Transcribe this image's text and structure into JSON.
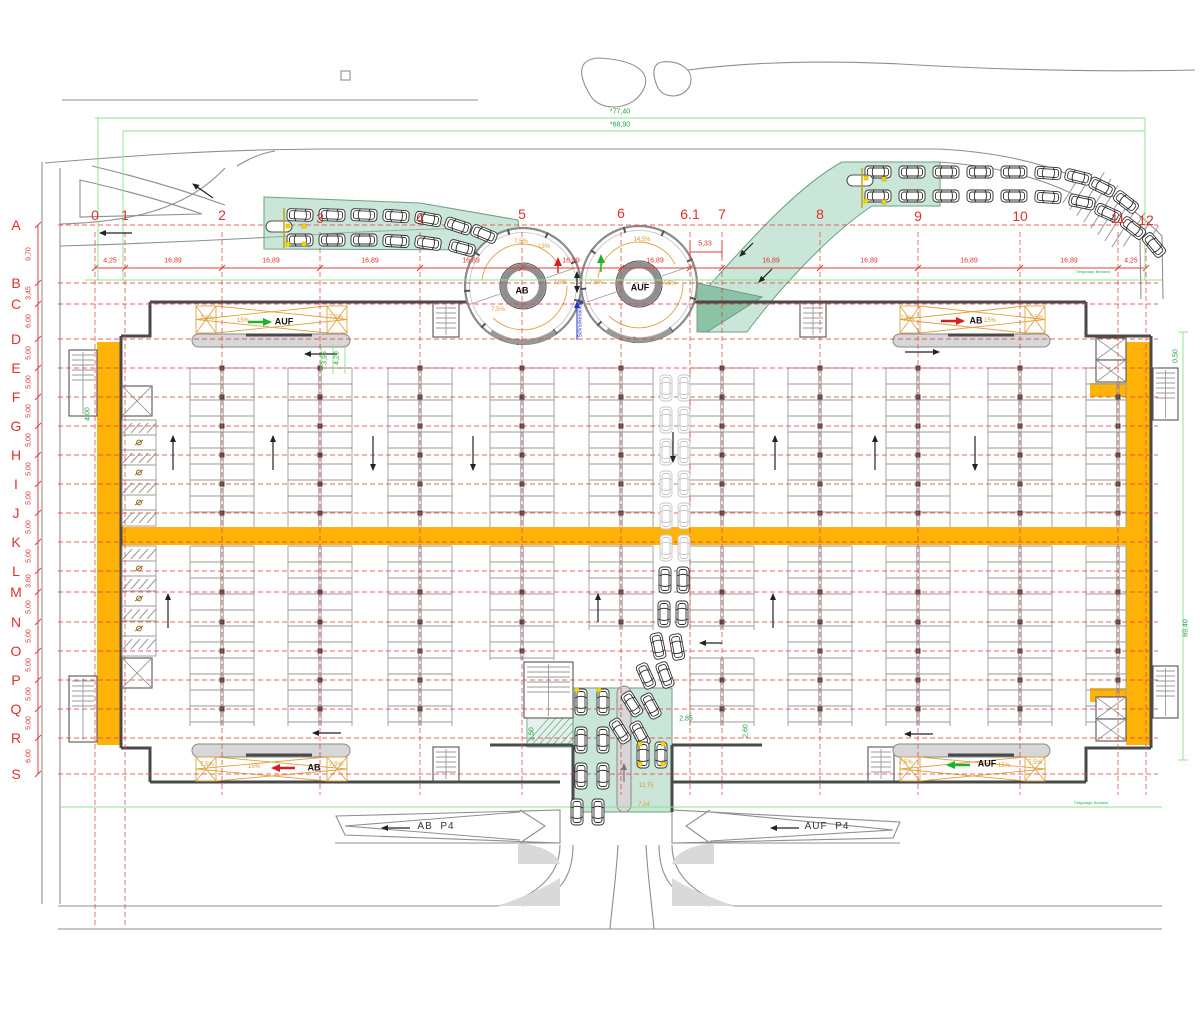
{
  "drawing_type": "parking-garage-floor-plan",
  "grid": {
    "columns": [
      {
        "label": "0",
        "x": 95,
        "y": 215
      },
      {
        "label": "1",
        "x": 125,
        "y": 215
      },
      {
        "label": "2",
        "x": 222,
        "y": 215
      },
      {
        "label": "3",
        "x": 320,
        "y": 218
      },
      {
        "label": "4",
        "x": 420,
        "y": 218
      },
      {
        "label": "5",
        "x": 522,
        "y": 214
      },
      {
        "label": "6",
        "x": 621,
        "y": 213
      },
      {
        "label": "6.1",
        "x": 690,
        "y": 214
      },
      {
        "label": "7",
        "x": 722,
        "y": 214
      },
      {
        "label": "8",
        "x": 820,
        "y": 214
      },
      {
        "label": "9",
        "x": 918,
        "y": 216
      },
      {
        "label": "10",
        "x": 1020,
        "y": 216
      },
      {
        "label": "11",
        "x": 1118,
        "y": 218
      },
      {
        "label": "12",
        "x": 1146,
        "y": 220
      }
    ],
    "rows": [
      {
        "label": "A",
        "y": 225
      },
      {
        "label": "B",
        "y": 283
      },
      {
        "label": "C",
        "y": 304
      },
      {
        "label": "D",
        "y": 339
      },
      {
        "label": "E",
        "y": 368
      },
      {
        "label": "F",
        "y": 397
      },
      {
        "label": "G",
        "y": 426
      },
      {
        "label": "H",
        "y": 455
      },
      {
        "label": "I",
        "y": 484
      },
      {
        "label": "J",
        "y": 513
      },
      {
        "label": "K",
        "y": 542
      },
      {
        "label": "L",
        "y": 571
      },
      {
        "label": "M",
        "y": 592
      },
      {
        "label": "N",
        "y": 622
      },
      {
        "label": "O",
        "y": 651
      },
      {
        "label": "P",
        "y": 680
      },
      {
        "label": "Q",
        "y": 709
      },
      {
        "label": "R",
        "y": 738
      },
      {
        "label": "S",
        "y": 774
      }
    ]
  },
  "dimensions": {
    "top_chain": [
      {
        "t": "4,25",
        "x": 110
      },
      {
        "t": "16,89",
        "x": 173
      },
      {
        "t": "16,89",
        "x": 271
      },
      {
        "t": "16,89",
        "x": 370
      },
      {
        "t": "16,89",
        "x": 471
      },
      {
        "t": "16,89",
        "x": 571
      },
      {
        "t": "16,89",
        "x": 655
      },
      {
        "t": "16,89",
        "x": 771
      },
      {
        "t": "16,89",
        "x": 869
      },
      {
        "t": "16,89",
        "x": 969
      },
      {
        "t": "16,89",
        "x": 1069
      },
      {
        "t": "4,25",
        "x": 1131
      }
    ],
    "left_chain": [
      {
        "t": "9,70",
        "y": 254
      },
      {
        "t": "3,45",
        "y": 293
      },
      {
        "t": "6,00",
        "y": 321
      },
      {
        "t": "5,00",
        "y": 353
      },
      {
        "t": "5,00",
        "y": 382
      },
      {
        "t": "5,00",
        "y": 411
      },
      {
        "t": "5,00",
        "y": 440
      },
      {
        "t": "5,00",
        "y": 469
      },
      {
        "t": "5,00",
        "y": 498
      },
      {
        "t": "5,00",
        "y": 527
      },
      {
        "t": "5,00",
        "y": 556
      },
      {
        "t": "3,60",
        "y": 581
      },
      {
        "t": "5,00",
        "y": 607
      },
      {
        "t": "5,00",
        "y": 636
      },
      {
        "t": "5,00",
        "y": 665
      },
      {
        "t": "5,00",
        "y": 694
      },
      {
        "t": "5,00",
        "y": 723
      },
      {
        "t": "6,00",
        "y": 756
      }
    ],
    "overall": [
      {
        "t": "*77,40",
        "x": 620,
        "y": 112
      },
      {
        "t": "*68,90",
        "x": 620,
        "y": 125
      },
      {
        "t": "69,40",
        "x": 1186,
        "y": 628,
        "rot": 1
      }
    ],
    "local": [
      {
        "t": "5,33",
        "x": 705,
        "y": 244,
        "cls": "t-dim"
      },
      {
        "t": "3,95",
        "x": 325,
        "y": 358,
        "rot": 1
      },
      {
        "t": "4,20",
        "x": 337,
        "y": 358,
        "rot": 1
      },
      {
        "t": "4,00",
        "x": 88,
        "y": 414,
        "rot": 1
      },
      {
        "t": "0,50",
        "x": 1176,
        "y": 356,
        "rot": 1
      },
      {
        "t": "2,85",
        "x": 686,
        "y": 719
      },
      {
        "t": "2,60",
        "x": 746,
        "y": 731,
        "rot": 1
      },
      {
        "t": "2,50",
        "x": 532,
        "y": 734,
        "rot": 1
      },
      {
        "t": "12,75",
        "x": 646,
        "y": 786,
        "cls": "t-org"
      },
      {
        "t": "7,04",
        "x": 644,
        "y": 805,
        "cls": "t-org"
      }
    ]
  },
  "ramps": {
    "inner_labels": [
      {
        "t": "AUF",
        "x": 284,
        "y": 322
      },
      {
        "t": "AB",
        "x": 976,
        "y": 321
      },
      {
        "t": "AB",
        "x": 314,
        "y": 768
      },
      {
        "t": "AUF",
        "x": 987,
        "y": 764
      }
    ],
    "spiral_labels": [
      {
        "t": "AB",
        "x": 522,
        "y": 291
      },
      {
        "t": "AUF",
        "x": 640,
        "y": 288
      }
    ],
    "grade_labels": [
      {
        "t": "7,5%",
        "x": 207,
        "y": 319
      },
      {
        "t": "15%",
        "x": 243,
        "y": 321
      },
      {
        "t": "7,5%",
        "x": 336,
        "y": 318
      },
      {
        "t": "7,5%",
        "x": 907,
        "y": 319
      },
      {
        "t": "15%",
        "x": 990,
        "y": 321
      },
      {
        "t": "7,5%",
        "x": 1036,
        "y": 318
      },
      {
        "t": "7,5%",
        "x": 207,
        "y": 765
      },
      {
        "t": "15%",
        "x": 254,
        "y": 767
      },
      {
        "t": "7,5%",
        "x": 336,
        "y": 765
      },
      {
        "t": "7,5%",
        "x": 906,
        "y": 763
      },
      {
        "t": "15%",
        "x": 1004,
        "y": 766
      },
      {
        "t": "7,5%",
        "x": 1035,
        "y": 763
      },
      {
        "t": "7,5%",
        "x": 521,
        "y": 242
      },
      {
        "t": "13%",
        "x": 544,
        "y": 247
      },
      {
        "t": "14,5%",
        "x": 642,
        "y": 240
      },
      {
        "t": "7,5%",
        "x": 498,
        "y": 310
      },
      {
        "t": "7,5%",
        "x": 560,
        "y": 283
      },
      {
        "t": "7,5%",
        "x": 596,
        "y": 283
      },
      {
        "t": "14,5%",
        "x": 668,
        "y": 284
      }
    ]
  },
  "roads": {
    "labels": [
      {
        "t": "AB  P4",
        "x": 436,
        "y": 827
      },
      {
        "t": "AUF  P4",
        "x": 827,
        "y": 827
      }
    ]
  },
  "notes": [
    {
      "t": "Schrankenanlage",
      "x": 581,
      "y": 318,
      "cls": "t-blue rot"
    },
    {
      "t": "Tiefgarage Bestand",
      "x": 1093,
      "y": 272,
      "cls": "t-tinyg"
    },
    {
      "t": "Tiefgarage Bestand",
      "x": 1091,
      "y": 803,
      "cls": "t-tinyg"
    }
  ],
  "colors": {
    "grid_red": "#e0322e",
    "lane_orange": "#ffb306",
    "ramp_green_fill": "#96cdb4",
    "dim_green": "#1fa33c",
    "marking_orange": "#e2a23f",
    "auf_arrow": "#1db12d",
    "ab_arrow": "#d42020"
  }
}
